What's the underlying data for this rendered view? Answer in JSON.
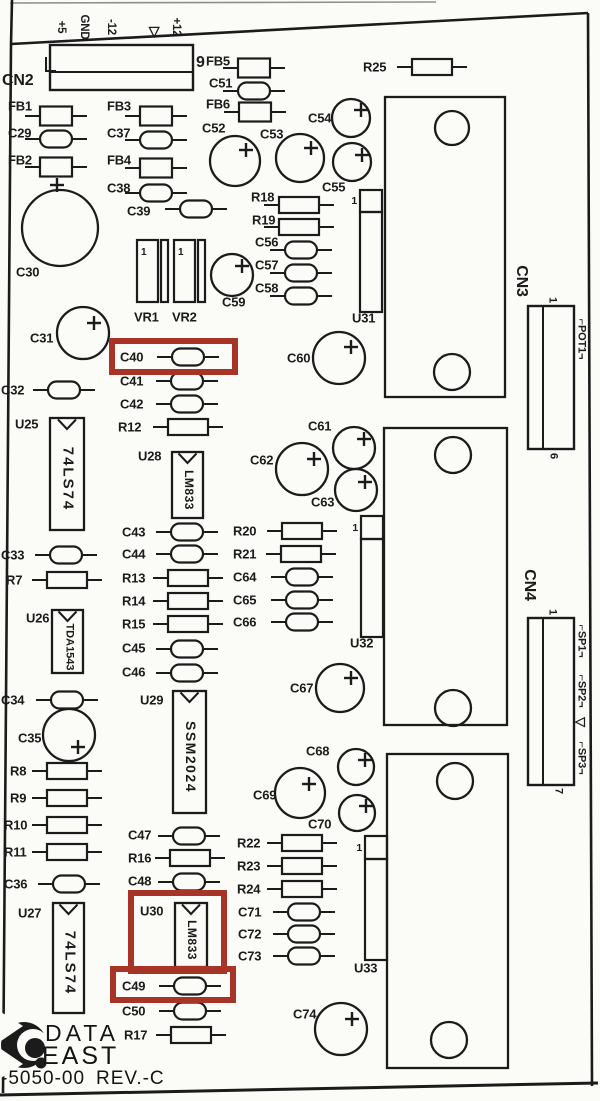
{
  "colors": {
    "ink": "#1b1b1b",
    "paper": "#fbfbf8",
    "highlight": "#a83428",
    "faint": "#8f8f8a"
  },
  "footer": {
    "brand_line1": "DATA",
    "brand_line2": "EAST",
    "part_number": "-5050-00",
    "revision": "REV.-C"
  },
  "connectors": {
    "cn2": {
      "ref": "CN2",
      "end_pin": "9",
      "pins": [
        {
          "t": "+5",
          "x": 60
        },
        {
          "t": "GND",
          "x": 83
        },
        {
          "t": "-12",
          "x": 110
        },
        {
          "t": "▽",
          "x": 154
        },
        {
          "t": "+12",
          "x": 175
        }
      ]
    },
    "cn3": {
      "ref": "CN3",
      "pin_top": "1",
      "pin_bottom": "6",
      "signals": [
        {
          "t": "⌐POT1¬",
          "y": 339
        }
      ]
    },
    "cn4": {
      "ref": "CN4",
      "pin_top": "1",
      "pin_bottom": "7",
      "signals": [
        {
          "t": "⌐SP1¬",
          "y": 641
        },
        {
          "t": "⌐SP2¬",
          "y": 691
        },
        {
          "t": "▽",
          "y": 722
        },
        {
          "t": "⌐SP3¬",
          "y": 758
        }
      ]
    }
  },
  "parts": [
    {
      "ref": "FB1",
      "kind": "fb",
      "lx": 8,
      "ly": 106,
      "cx": 56,
      "cy": 116
    },
    {
      "ref": "C29",
      "kind": "cap",
      "lx": 8,
      "ly": 133,
      "cx": 56,
      "cy": 139
    },
    {
      "ref": "FB2",
      "kind": "fb",
      "lx": 8,
      "ly": 160,
      "cx": 56,
      "cy": 167
    },
    {
      "ref": "FB3",
      "kind": "fb",
      "lx": 107,
      "ly": 106,
      "cx": 156,
      "cy": 116
    },
    {
      "ref": "C37",
      "kind": "cap",
      "lx": 107,
      "ly": 133,
      "cx": 156,
      "cy": 140
    },
    {
      "ref": "FB4",
      "kind": "fb",
      "lx": 107,
      "ly": 160,
      "cx": 156,
      "cy": 168
    },
    {
      "ref": "C38",
      "kind": "cap",
      "lx": 107,
      "ly": 188,
      "cx": 156,
      "cy": 193
    },
    {
      "ref": "C39",
      "kind": "cap",
      "lx": 127,
      "ly": 211,
      "cx": 196,
      "cy": 209
    },
    {
      "ref": "FB5",
      "kind": "fb",
      "lx": 206,
      "ly": 61,
      "cx": 254,
      "cy": 68
    },
    {
      "ref": "C51",
      "kind": "cap",
      "lx": 209,
      "ly": 83,
      "cx": 254,
      "cy": 91
    },
    {
      "ref": "FB6",
      "kind": "fb",
      "lx": 206,
      "ly": 104,
      "cx": 255,
      "cy": 112
    },
    {
      "ref": "R25",
      "kind": "res",
      "lx": 363,
      "ly": 67,
      "cx": 432,
      "cy": 67
    },
    {
      "ref": "R18",
      "kind": "res",
      "lx": 251,
      "ly": 197,
      "cx": 299,
      "cy": 205
    },
    {
      "ref": "R19",
      "kind": "res",
      "lx": 252,
      "ly": 220,
      "cx": 299,
      "cy": 227
    },
    {
      "ref": "C56",
      "kind": "cap",
      "lx": 255,
      "ly": 242,
      "cx": 301,
      "cy": 250
    },
    {
      "ref": "C57",
      "kind": "cap",
      "lx": 255,
      "ly": 265,
      "cx": 301,
      "cy": 273
    },
    {
      "ref": "C58",
      "kind": "cap",
      "lx": 255,
      "ly": 288,
      "cx": 301,
      "cy": 296
    },
    {
      "ref": "C32",
      "kind": "cap",
      "lx": 1,
      "ly": 390,
      "cx": 64,
      "cy": 390
    },
    {
      "ref": "C40",
      "kind": "cap",
      "lx": 120,
      "ly": 357,
      "cx": 188,
      "cy": 357
    },
    {
      "ref": "C41",
      "kind": "cap",
      "lx": 120,
      "ly": 381,
      "cx": 187,
      "cy": 381
    },
    {
      "ref": "C42",
      "kind": "cap",
      "lx": 120,
      "ly": 404,
      "cx": 187,
      "cy": 404
    },
    {
      "ref": "R12",
      "kind": "res",
      "lx": 118,
      "ly": 427,
      "cx": 188,
      "cy": 427
    },
    {
      "ref": "C43",
      "kind": "cap",
      "lx": 122,
      "ly": 532,
      "cx": 187,
      "cy": 532
    },
    {
      "ref": "C44",
      "kind": "cap",
      "lx": 122,
      "ly": 554,
      "cx": 187,
      "cy": 554
    },
    {
      "ref": "R13",
      "kind": "res",
      "lx": 122,
      "ly": 578,
      "cx": 188,
      "cy": 578
    },
    {
      "ref": "R14",
      "kind": "res",
      "lx": 122,
      "ly": 601,
      "cx": 188,
      "cy": 601
    },
    {
      "ref": "R15",
      "kind": "res",
      "lx": 122,
      "ly": 624,
      "cx": 188,
      "cy": 624
    },
    {
      "ref": "C45",
      "kind": "cap",
      "lx": 122,
      "ly": 648,
      "cx": 187,
      "cy": 649
    },
    {
      "ref": "C46",
      "kind": "cap",
      "lx": 122,
      "ly": 672,
      "cx": 187,
      "cy": 673
    },
    {
      "ref": "C33",
      "kind": "cap",
      "lx": 1,
      "ly": 555,
      "cx": 66,
      "cy": 555
    },
    {
      "ref": "R7",
      "kind": "res",
      "lx": 6,
      "ly": 580,
      "cx": 67,
      "cy": 580
    },
    {
      "ref": "R20",
      "kind": "res",
      "lx": 233,
      "ly": 531,
      "cx": 302,
      "cy": 531
    },
    {
      "ref": "R21",
      "kind": "res",
      "lx": 233,
      "ly": 554,
      "cx": 301,
      "cy": 554
    },
    {
      "ref": "C64",
      "kind": "cap",
      "lx": 233,
      "ly": 577,
      "cx": 302,
      "cy": 577
    },
    {
      "ref": "C65",
      "kind": "cap",
      "lx": 233,
      "ly": 600,
      "cx": 302,
      "cy": 600
    },
    {
      "ref": "C66",
      "kind": "cap",
      "lx": 233,
      "ly": 622,
      "cx": 302,
      "cy": 622
    },
    {
      "ref": "C34",
      "kind": "cap",
      "lx": 1,
      "ly": 700,
      "cx": 67,
      "cy": 700
    },
    {
      "ref": "R8",
      "kind": "res",
      "lx": 10,
      "ly": 771,
      "cx": 67,
      "cy": 771
    },
    {
      "ref": "R9",
      "kind": "res",
      "lx": 10,
      "ly": 798,
      "cx": 67,
      "cy": 798
    },
    {
      "ref": "R10",
      "kind": "res",
      "lx": 4,
      "ly": 825,
      "cx": 67,
      "cy": 825
    },
    {
      "ref": "R11",
      "kind": "res",
      "lx": 4,
      "ly": 852,
      "cx": 67,
      "cy": 852
    },
    {
      "ref": "C36",
      "kind": "cap",
      "lx": 4,
      "ly": 884,
      "cx": 69,
      "cy": 884
    },
    {
      "ref": "C47",
      "kind": "cap",
      "lx": 128,
      "ly": 835,
      "cx": 189,
      "cy": 836
    },
    {
      "ref": "R16",
      "kind": "res",
      "lx": 128,
      "ly": 858,
      "cx": 190,
      "cy": 858
    },
    {
      "ref": "C48",
      "kind": "cap",
      "lx": 128,
      "ly": 881,
      "cx": 189,
      "cy": 882
    },
    {
      "ref": "R22",
      "kind": "res",
      "lx": 237,
      "ly": 843,
      "cx": 302,
      "cy": 843
    },
    {
      "ref": "R23",
      "kind": "res",
      "lx": 237,
      "ly": 866,
      "cx": 302,
      "cy": 866
    },
    {
      "ref": "R24",
      "kind": "res",
      "lx": 237,
      "ly": 889,
      "cx": 302,
      "cy": 889
    },
    {
      "ref": "C71",
      "kind": "cap",
      "lx": 238,
      "ly": 912,
      "cx": 304,
      "cy": 912
    },
    {
      "ref": "C72",
      "kind": "cap",
      "lx": 238,
      "ly": 934,
      "cx": 304,
      "cy": 934
    },
    {
      "ref": "C73",
      "kind": "cap",
      "lx": 238,
      "ly": 956,
      "cx": 304,
      "cy": 956
    },
    {
      "ref": "C49",
      "kind": "cap",
      "lx": 122,
      "ly": 986,
      "cx": 190,
      "cy": 986
    },
    {
      "ref": "C50",
      "kind": "cap",
      "lx": 122,
      "ly": 1011,
      "cx": 190,
      "cy": 1011
    },
    {
      "ref": "R17",
      "kind": "res",
      "lx": 124,
      "ly": 1035,
      "cx": 191,
      "cy": 1035
    }
  ],
  "ecaps": [
    {
      "ref": "C30",
      "lx": 16,
      "ly": 272,
      "cx": 60,
      "cy": 228,
      "r": 38,
      "px": 57,
      "py": 185
    },
    {
      "ref": "C31",
      "lx": 30,
      "ly": 338,
      "cx": 83,
      "cy": 333,
      "r": 26,
      "px": 94,
      "py": 323
    },
    {
      "ref": "C35",
      "lx": 18,
      "ly": 738,
      "cx": 69,
      "cy": 735,
      "r": 26,
      "px": 78,
      "py": 747
    },
    {
      "ref": "C52",
      "lx": 202,
      "ly": 128,
      "cx": 235,
      "cy": 161,
      "r": 25,
      "px": 246,
      "py": 150
    },
    {
      "ref": "C53",
      "lx": 260,
      "ly": 134,
      "cx": 300,
      "cy": 158,
      "r": 24,
      "px": 311,
      "py": 148
    },
    {
      "ref": "C54",
      "lx": 308,
      "ly": 118,
      "cx": 351,
      "cy": 118,
      "r": 19,
      "px": 361,
      "py": 110
    },
    {
      "ref": "C55",
      "lx": 322,
      "ly": 187,
      "cx": 352,
      "cy": 162,
      "r": 19,
      "px": 362,
      "py": 155
    },
    {
      "ref": "C59",
      "lx": 222,
      "ly": 302,
      "cx": 232,
      "cy": 275,
      "r": 21,
      "px": 242,
      "py": 266
    },
    {
      "ref": "C60",
      "lx": 287,
      "ly": 358,
      "cx": 339,
      "cy": 358,
      "r": 26,
      "px": 351,
      "py": 347
    },
    {
      "ref": "C61",
      "lx": 308,
      "ly": 426,
      "cx": 354,
      "cy": 448,
      "r": 21,
      "px": 364,
      "py": 439
    },
    {
      "ref": "C62",
      "lx": 250,
      "ly": 460,
      "cx": 302,
      "cy": 469,
      "r": 26,
      "px": 314,
      "py": 459
    },
    {
      "ref": "C63",
      "lx": 311,
      "ly": 502,
      "cx": 356,
      "cy": 490,
      "r": 21,
      "px": 365,
      "py": 482
    },
    {
      "ref": "C67",
      "lx": 290,
      "ly": 688,
      "cx": 340,
      "cy": 688,
      "r": 24,
      "px": 351,
      "py": 678
    },
    {
      "ref": "C68",
      "lx": 306,
      "ly": 751,
      "cx": 356,
      "cy": 767,
      "r": 18,
      "px": 365,
      "py": 760
    },
    {
      "ref": "C69",
      "lx": 253,
      "ly": 795,
      "cx": 300,
      "cy": 793,
      "r": 25,
      "px": 309,
      "py": 784
    },
    {
      "ref": "C70",
      "lx": 308,
      "ly": 824,
      "cx": 357,
      "cy": 813,
      "r": 18,
      "px": 366,
      "py": 806
    },
    {
      "ref": "C74",
      "lx": 293,
      "ly": 1014,
      "cx": 341,
      "cy": 1029,
      "r": 26,
      "px": 352,
      "py": 1019
    }
  ],
  "dips": [
    {
      "ref": "U25",
      "lx": 15,
      "ly": 424,
      "x": 50,
      "y": 418,
      "w": 34,
      "h": 112,
      "text": "74LS74",
      "fs": 15,
      "ls": 2
    },
    {
      "ref": "U26",
      "lx": 26,
      "ly": 618,
      "x": 52,
      "y": 610,
      "w": 31,
      "h": 63,
      "text": "TDA1543",
      "fs": 11,
      "ls": 0
    },
    {
      "ref": "U27",
      "lx": 18,
      "ly": 913,
      "x": 53,
      "y": 903,
      "w": 31,
      "h": 110,
      "text": "74LS74",
      "fs": 15,
      "ls": 2
    },
    {
      "ref": "U28",
      "lx": 138,
      "ly": 456,
      "x": 172,
      "y": 452,
      "w": 31,
      "h": 66,
      "text": "LM833",
      "fs": 12,
      "ls": 0.5
    },
    {
      "ref": "U29",
      "lx": 140,
      "ly": 700,
      "x": 173,
      "y": 691,
      "w": 33,
      "h": 122,
      "text": "SSM2024",
      "fs": 14,
      "ls": 1.5
    },
    {
      "ref": "U30",
      "lx": 140,
      "ly": 911,
      "x": 175,
      "y": 903,
      "w": 32,
      "h": 64,
      "text": "LM833",
      "fs": 12,
      "ls": 0.5
    }
  ],
  "sips": [
    {
      "ref": "U31",
      "one": "1",
      "x": 360,
      "y": 190,
      "w": 22,
      "sq": 22,
      "bh": 100,
      "lx": 352,
      "ly": 318,
      "ox": 357,
      "oy": 201
    },
    {
      "ref": "U32",
      "one": "1",
      "x": 361,
      "y": 516,
      "w": 22,
      "sq": 23,
      "bh": 98,
      "lx": 350,
      "ly": 643,
      "ox": 358,
      "oy": 528
    },
    {
      "ref": "U33",
      "one": "1",
      "x": 365,
      "y": 836,
      "w": 22,
      "sq": 23,
      "bh": 101,
      "lx": 354,
      "ly": 968,
      "ox": 362,
      "oy": 848
    }
  ],
  "vrs": [
    {
      "ref": "VR1",
      "one": "1",
      "x": 137,
      "y": 240,
      "lx": 134,
      "ly": 317
    },
    {
      "ref": "VR2",
      "one": "1",
      "x": 174,
      "y": 240,
      "lx": 172,
      "ly": 317
    }
  ],
  "heatsinks": [
    {
      "x": 385,
      "y": 97,
      "w": 120,
      "h": 300,
      "holes": [
        [
          452,
          128,
          17
        ],
        [
          452,
          372,
          18
        ]
      ]
    },
    {
      "x": 384,
      "y": 428,
      "w": 123,
      "h": 297,
      "holes": [
        [
          453,
          455,
          18
        ],
        [
          453,
          708,
          18
        ]
      ]
    },
    {
      "x": 387,
      "y": 754,
      "w": 121,
      "h": 314,
      "holes": [
        [
          455,
          781,
          18
        ],
        [
          449,
          1040,
          18
        ]
      ]
    }
  ],
  "highlights": [
    {
      "for": "C40",
      "x": 112,
      "y": 341,
      "w": 123,
      "h": 31
    },
    {
      "for": "U30",
      "x": 131,
      "y": 893,
      "w": 93,
      "h": 78
    },
    {
      "for": "C49",
      "x": 113,
      "y": 969,
      "w": 120,
      "h": 31
    }
  ]
}
